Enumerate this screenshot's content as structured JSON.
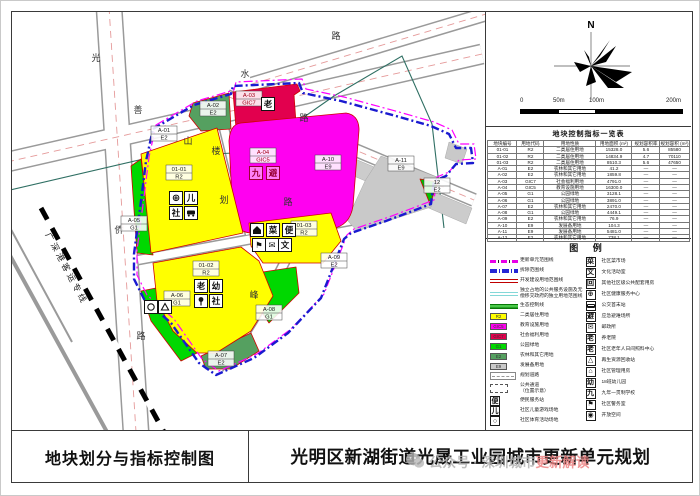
{
  "titles": {
    "left": "地块划分与指标控制图",
    "right": "光明区新湖街道光晟工业园城市更新单元规划"
  },
  "watermark": {
    "prefix": "公众号 · 深圳城市",
    "highlight": "更新解读"
  },
  "north": {
    "label": "N"
  },
  "scalebar": {
    "labels": [
      "0",
      "50m",
      "100m",
      "200m"
    ]
  },
  "table": {
    "title": "地块控制指标一览表",
    "headers": [
      "地块编号",
      "用地代码",
      "用地性质",
      "用地面积 (m²)",
      "规划容积率",
      "规划容积 (m²)"
    ],
    "rows": [
      [
        "01-01",
        "R2",
        "二类居住用地",
        "15328.0",
        "5.6",
        "85580"
      ],
      [
        "01-02",
        "R2",
        "二类居住用地",
        "14834.9",
        "4.7",
        "70110"
      ],
      [
        "01-03",
        "R2",
        "二类居住用地",
        "8510.3",
        "5.6",
        "47650"
      ],
      [
        "A-01",
        "E2",
        "农林和其它用地",
        "41.2",
        "—",
        "—"
      ],
      [
        "A-02",
        "E2",
        "农林和其它用地",
        "1859.8",
        "—",
        "—"
      ],
      [
        "A-03",
        "GIC7",
        "社会福利用地",
        "4791.0",
        "—",
        "—"
      ],
      [
        "A-04",
        "GIC5",
        "教育设施用地",
        "16300.0",
        "—",
        "—"
      ],
      [
        "A-05",
        "G1",
        "公园绿地",
        "3128.1",
        "—",
        "—"
      ],
      [
        "A-06",
        "G1",
        "公园绿地",
        "3891.0",
        "—",
        "—"
      ],
      [
        "A-07",
        "E2",
        "农林和其它用地",
        "2470.0",
        "—",
        "—"
      ],
      [
        "A-08",
        "G1",
        "公园绿地",
        "4449.1",
        "—",
        "—"
      ],
      [
        "A-09",
        "E2",
        "农林和其它用地",
        "76.9",
        "—",
        "—"
      ],
      [
        "A-10",
        "E9",
        "发展备用地",
        "104.3",
        "—",
        "—"
      ],
      [
        "A-11",
        "E9",
        "发展备用地",
        "5481.0",
        "—",
        "—"
      ],
      [
        "A-12",
        "E2",
        "农林和其它用地",
        "738.1",
        "—",
        "—"
      ]
    ]
  },
  "legend": {
    "title": "图  例",
    "left": [
      {
        "k": "l-mag",
        "label": "更新单元范围线"
      },
      {
        "k": "l-blue",
        "label": "拆除范围线"
      },
      {
        "k": "l-red",
        "label": "开发建设用地范围线"
      },
      {
        "k": "l-cyan",
        "label": "独立占地的公共服务设施及无",
        "label2": "偿移交政府的独立用地范围线"
      },
      {
        "k": "l-green",
        "label": "生态控制线"
      },
      {
        "k": "sw",
        "color": "#ffff00",
        "code": "R2",
        "label": "二类居住用地"
      },
      {
        "k": "sw",
        "color": "#ff00f0",
        "code": "GIC5",
        "label": "教育设施用地"
      },
      {
        "k": "sw",
        "color": "#e2004e",
        "code": "GIC7",
        "label": "社会福利用地"
      },
      {
        "k": "sw",
        "color": "#00d800",
        "code": "G1",
        "label": "公园绿地"
      },
      {
        "k": "sw",
        "color": "#55a060",
        "code": "E2",
        "label": "农林和其它用地"
      },
      {
        "k": "sw",
        "color": "#c9c9c9",
        "code": "E9",
        "label": "发展备用地"
      },
      {
        "k": "road",
        "label": "规划道路"
      },
      {
        "k": "dash",
        "label": "公共通道",
        "label2": "（位置示意）"
      },
      {
        "k": "g",
        "glyph": "便",
        "label": "便民服务站"
      },
      {
        "k": "g",
        "glyph": "儿",
        "label": "社区儿童游戏场地"
      },
      {
        "k": "g",
        "glyph": "○",
        "label": "社区体育活动场地"
      }
    ],
    "right": [
      {
        "glyph": "菜",
        "label": "社区菜市场"
      },
      {
        "glyph": "文",
        "label": "文化活动室"
      },
      {
        "glyph": "回",
        "label": "其他社区级公共配套用房"
      },
      {
        "glyph": "⊕",
        "label": "社区健康服务中心"
      },
      {
        "glyph": "bus",
        "label": "公交首末站"
      },
      {
        "glyph": "避",
        "label": "应急避难场所"
      },
      {
        "glyph": "✉",
        "label": "邮政所"
      },
      {
        "glyph": "老",
        "label": "养老院"
      },
      {
        "glyph": "老",
        "label": "社区老年人日间照料中心"
      },
      {
        "glyph": "△",
        "label": "再生资源回收站"
      },
      {
        "glyph": "⌂",
        "label": "社区管理用房"
      },
      {
        "glyph": "幼",
        "label": "18班幼儿园"
      },
      {
        "glyph": "九",
        "label": "九年一贯制学校"
      },
      {
        "glyph": "⚑",
        "label": "社区警务室"
      },
      {
        "glyph": "◉",
        "label": "开放空间"
      }
    ]
  },
  "map": {
    "railway_label": {
      "t": "广深港客运专线",
      "x": 52,
      "y": 258,
      "rot": 62
    },
    "road_labels": [
      {
        "t": "光",
        "x": 84,
        "y": 49
      },
      {
        "t": "善",
        "x": 126,
        "y": 101
      },
      {
        "t": "侨",
        "x": 107,
        "y": 221
      },
      {
        "t": "路",
        "x": 129,
        "y": 327
      },
      {
        "t": "水",
        "x": 233,
        "y": 65
      },
      {
        "t": "路",
        "x": 324,
        "y": 27
      },
      {
        "t": "路",
        "x": 292,
        "y": 109
      },
      {
        "t": "山",
        "x": 176,
        "y": 132
      },
      {
        "t": "楼",
        "x": 204,
        "y": 142
      },
      {
        "t": "划",
        "x": 212,
        "y": 191
      },
      {
        "t": "路",
        "x": 276,
        "y": 193
      },
      {
        "t": "峰",
        "x": 242,
        "y": 286
      },
      {
        "t": "路",
        "x": 207,
        "y": 349
      }
    ],
    "parcel_labels": [
      {
        "l1": "A-01",
        "l2": "E2",
        "x": 152,
        "y": 122
      },
      {
        "l1": "A-02",
        "l2": "E2",
        "x": 201,
        "y": 97
      },
      {
        "l1": "A-03",
        "l2": "GIC7",
        "x": 237,
        "y": 87,
        "red": true
      },
      {
        "l1": "A-04",
        "l2": "GIC5",
        "x": 251,
        "y": 144,
        "red": true
      },
      {
        "l1": "01-01",
        "l2": "R2",
        "x": 167,
        "y": 161
      },
      {
        "l1": "A-05",
        "l2": "G1",
        "x": 122,
        "y": 212
      },
      {
        "l1": "01-02",
        "l2": "R2",
        "x": 194,
        "y": 257
      },
      {
        "l1": "01-03",
        "l2": "R2",
        "x": 292,
        "y": 217
      },
      {
        "l1": "A-06",
        "l2": "G1",
        "x": 165,
        "y": 287
      },
      {
        "l1": "A-07",
        "l2": "E2",
        "x": 209,
        "y": 347
      },
      {
        "l1": "A-08",
        "l2": "G1",
        "x": 257,
        "y": 301
      },
      {
        "l1": "A-09",
        "l2": "E2",
        "x": 322,
        "y": 249
      },
      {
        "l1": "A-10",
        "l2": "E9",
        "x": 316,
        "y": 151
      },
      {
        "l1": "A-11",
        "l2": "E9",
        "x": 389,
        "y": 152
      },
      {
        "l1": "12",
        "l2": "E2",
        "x": 425,
        "y": 174
      }
    ],
    "icons": [
      {
        "kind": "plus",
        "glyph": "⊕",
        "x": 164,
        "y": 186,
        "name": "health-center-icon"
      },
      {
        "kind": "char",
        "glyph": "儿",
        "x": 179,
        "y": 186,
        "name": "children-play-icon"
      },
      {
        "kind": "char",
        "glyph": "社",
        "x": 164,
        "y": 201,
        "name": "community-icon"
      },
      {
        "kind": "bus",
        "glyph": "",
        "x": 179,
        "y": 201,
        "name": "bus-terminus-icon"
      },
      {
        "kind": "char",
        "glyph": "老",
        "x": 189,
        "y": 274,
        "name": "elderly-icon"
      },
      {
        "kind": "char",
        "glyph": "幼",
        "x": 204,
        "y": 274,
        "name": "kindergarten-icon"
      },
      {
        "kind": "pin",
        "glyph": "",
        "x": 189,
        "y": 289,
        "name": "pin-icon"
      },
      {
        "kind": "char",
        "glyph": "社",
        "x": 204,
        "y": 289,
        "name": "community-icon"
      },
      {
        "kind": "house",
        "glyph": "",
        "x": 245,
        "y": 218,
        "name": "management-house-icon"
      },
      {
        "kind": "char",
        "glyph": "菜",
        "x": 261,
        "y": 218,
        "name": "market-icon"
      },
      {
        "kind": "char",
        "glyph": "便",
        "x": 277,
        "y": 218,
        "name": "convenience-icon"
      },
      {
        "kind": "flag",
        "glyph": "⚑",
        "x": 247,
        "y": 233,
        "name": "police-icon"
      },
      {
        "kind": "mail",
        "glyph": "✉",
        "x": 260,
        "y": 233,
        "name": "post-icon"
      },
      {
        "kind": "char",
        "glyph": "文",
        "x": 273,
        "y": 233,
        "name": "culture-icon"
      },
      {
        "kind": "charred",
        "glyph": "九",
        "x": 244,
        "y": 161,
        "name": "school-icon"
      },
      {
        "kind": "charred",
        "glyph": "避",
        "x": 261,
        "y": 161,
        "name": "shelter-icon"
      },
      {
        "kind": "char",
        "glyph": "老",
        "x": 256,
        "y": 92,
        "name": "elderly-icon"
      },
      {
        "kind": "circ",
        "glyph": "",
        "x": 139,
        "y": 295,
        "name": "sports-ground-icon"
      },
      {
        "kind": "tri",
        "glyph": "",
        "x": 153,
        "y": 295,
        "name": "recycle-icon"
      }
    ]
  },
  "colors": {
    "residential": "#ffff00",
    "education": "#ff00f0",
    "welfare": "#e2004e",
    "park": "#00d800",
    "farmland": "#55a060",
    "reserve": "#c9c9c9",
    "demolish_line": "#1a1ad0",
    "unit_line": "#ff00ff",
    "eco_line": "#2f6f63"
  }
}
